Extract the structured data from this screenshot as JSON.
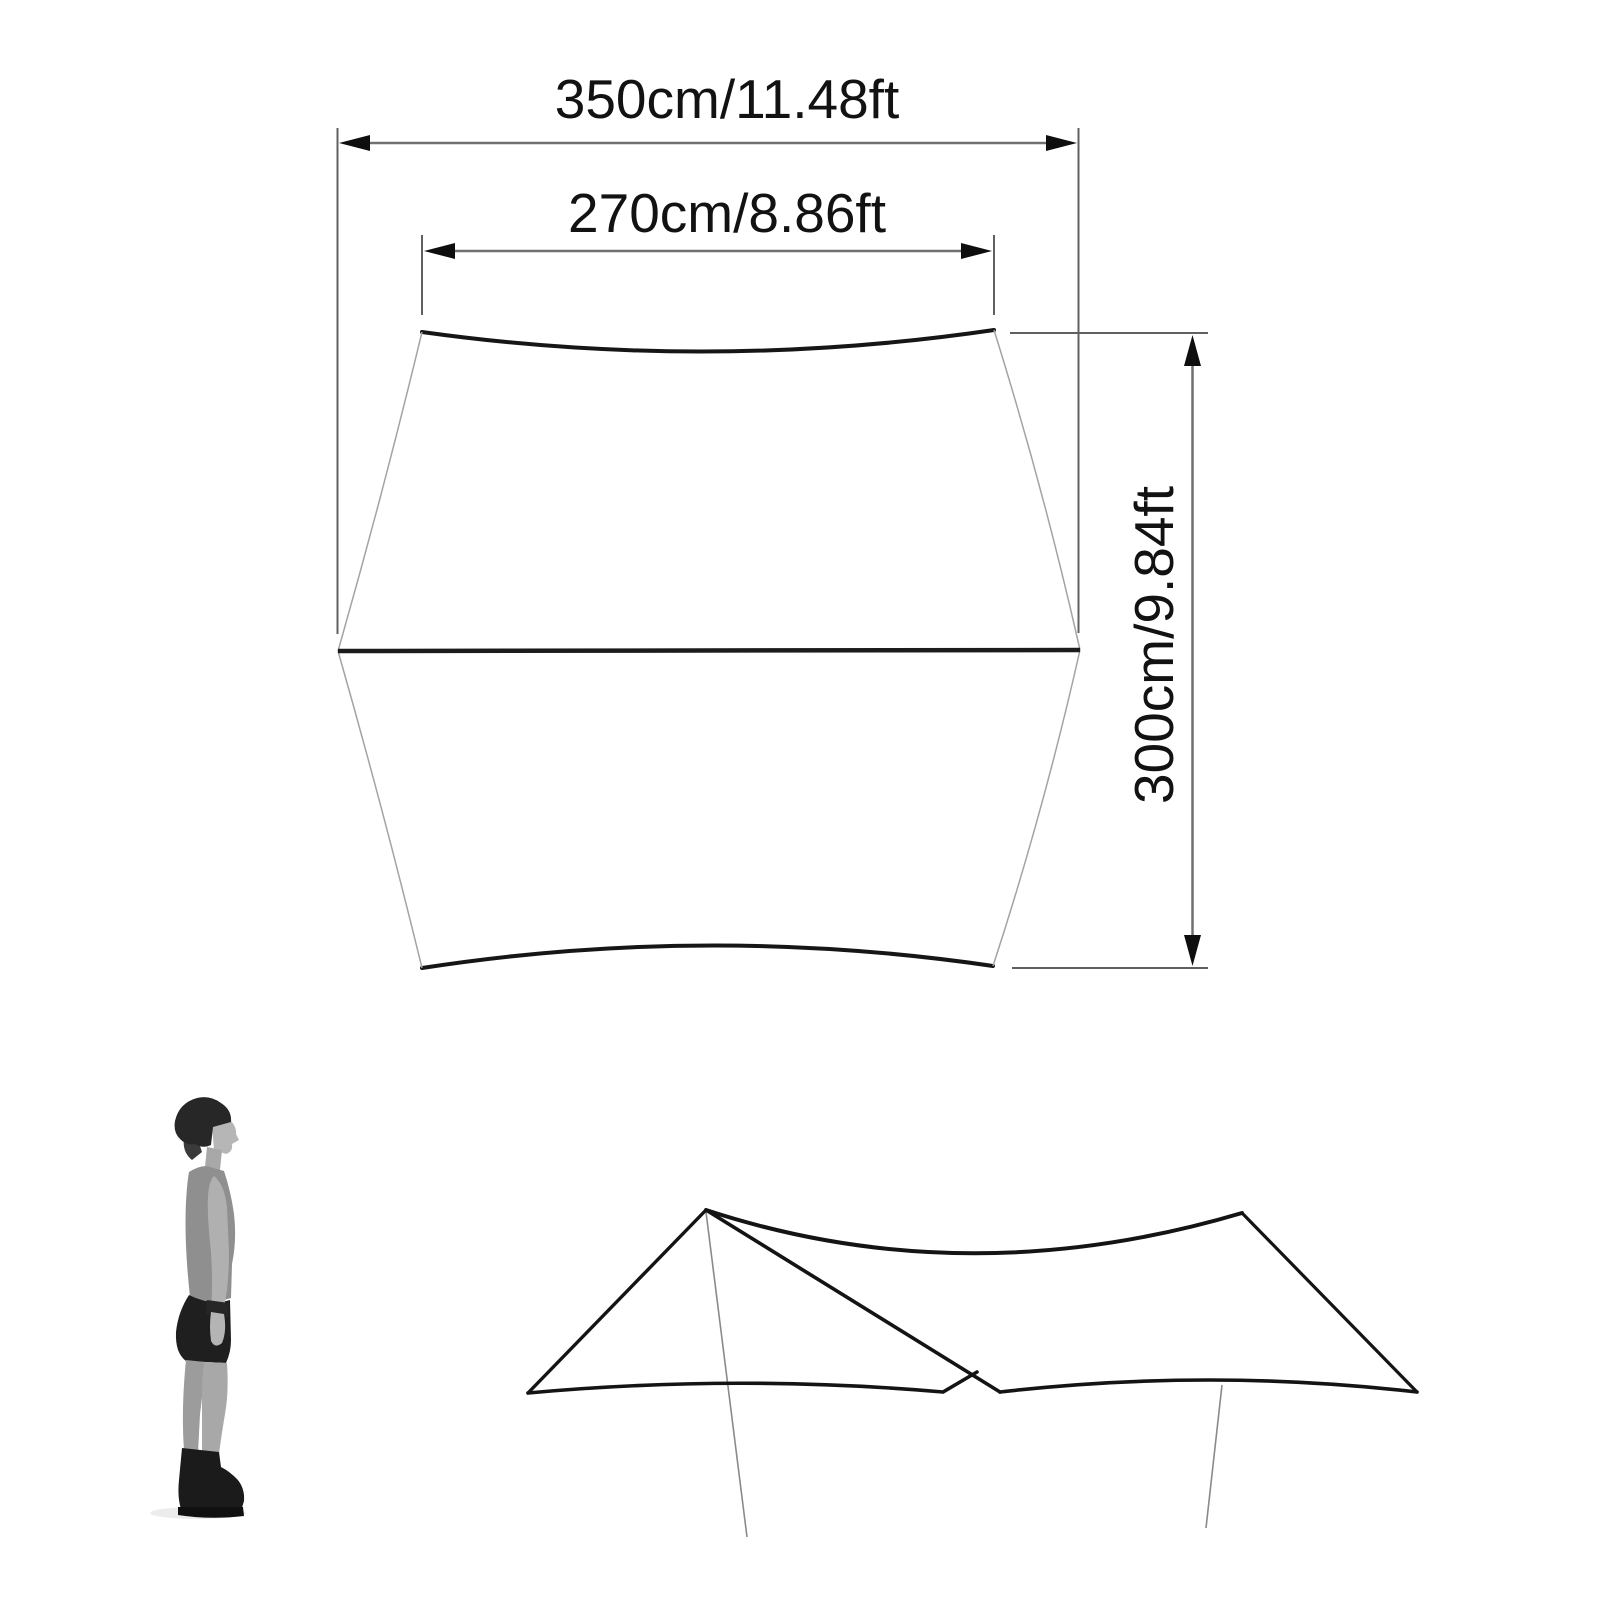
{
  "diagram": {
    "type": "tarp-dimension-diagram",
    "labels": {
      "outer_width": "350cm/11.48ft",
      "inner_width": "270cm/8.86ft",
      "depth": "300cm/9.84ft"
    },
    "colors": {
      "background": "#ffffff",
      "ink": "#141414",
      "thin_edge": "#a3a3a3",
      "dimension_line": "#666666",
      "pole_line": "#8a8a8a"
    }
  }
}
